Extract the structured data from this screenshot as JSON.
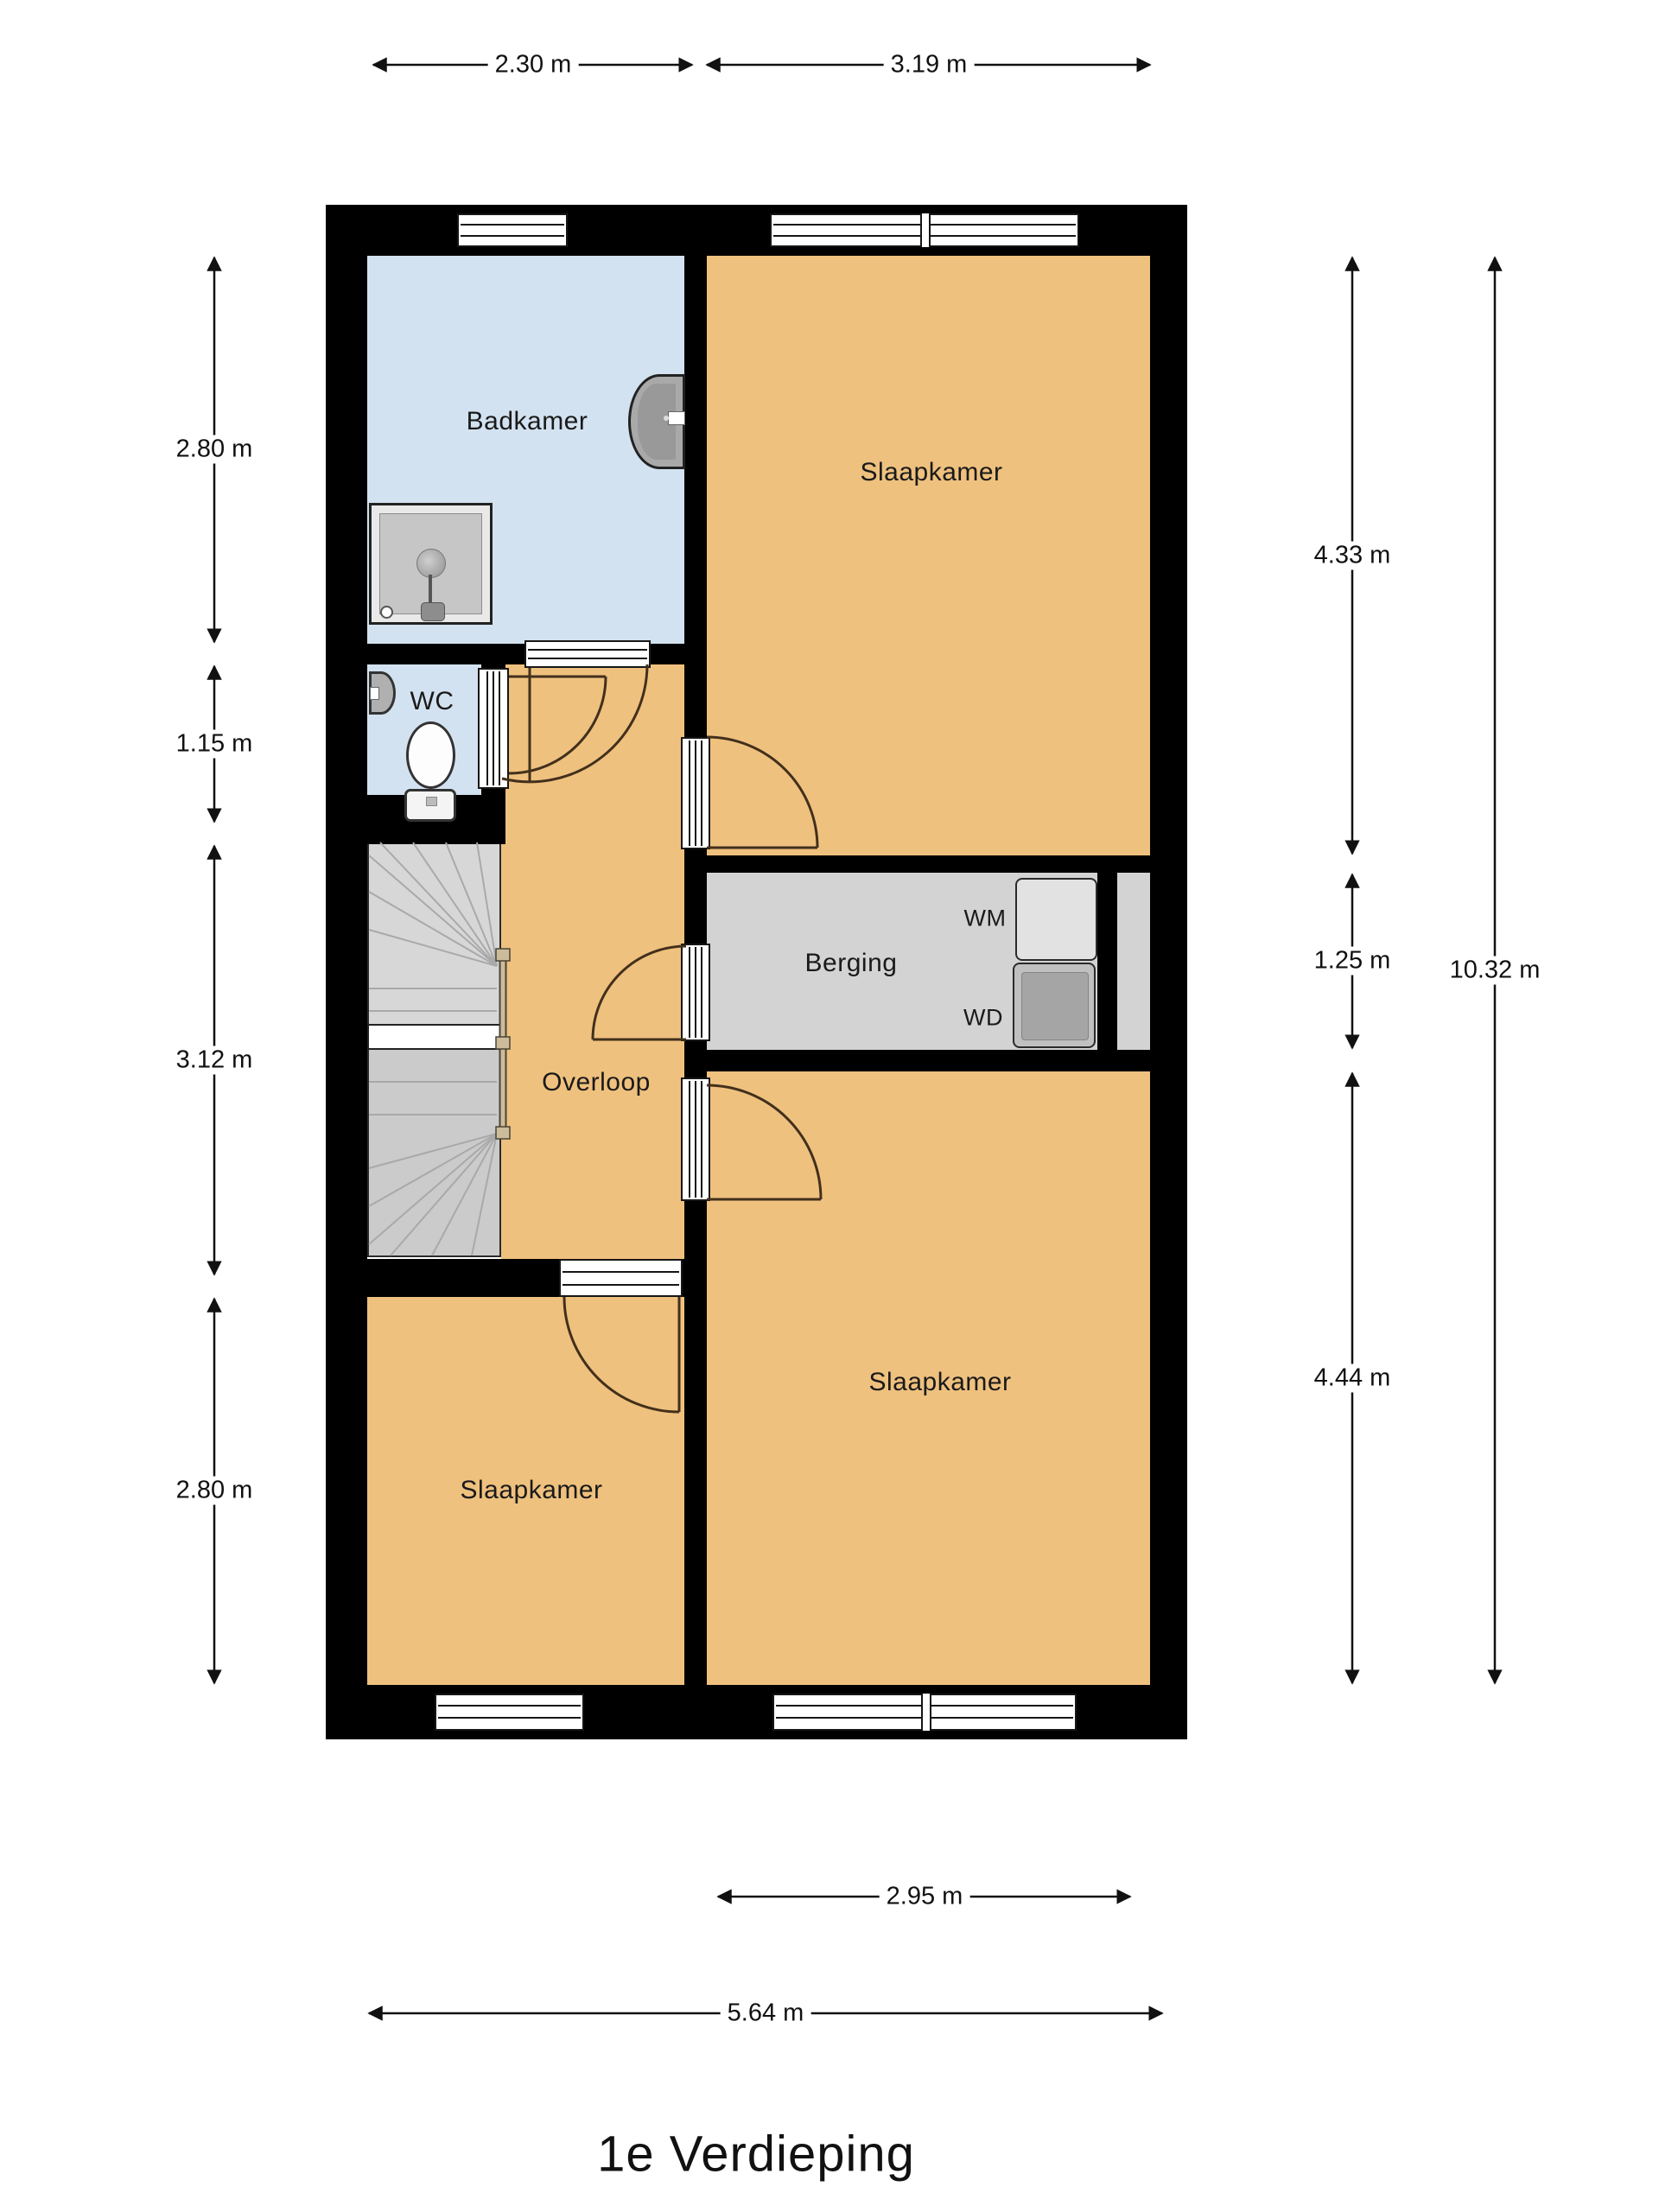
{
  "title": "1e Verdieping",
  "rooms": {
    "badkamer": "Badkamer",
    "wc": "WC",
    "overloop": "Overloop",
    "berging": "Berging",
    "slaapkamer_top": "Slaapkamer",
    "slaapkamer_left": "Slaapkamer",
    "slaapkamer_right": "Slaapkamer"
  },
  "appliances": {
    "washing_machine": "WM",
    "dryer": "WD"
  },
  "dimensions": {
    "top": [
      "2.30 m",
      "3.19 m"
    ],
    "left": [
      "2.80 m",
      "1.15 m",
      "3.12 m",
      "2.80 m"
    ],
    "right": [
      "4.33 m",
      "1.25 m",
      "4.44 m"
    ],
    "right_total": "10.32 m",
    "bottom": [
      "2.95 m",
      "5.64 m"
    ]
  },
  "colors": {
    "wall": "#000000",
    "room-orange": "#efc17e",
    "room-blue": "#d3e2f0",
    "room-gray": "#d3d3d3",
    "stairs-upper": "#d7d7d7",
    "stairs-lower": "#cbcbcb",
    "door-arc": "#42301c",
    "handrail": "#cdbc9b",
    "text": "#1a1a1a"
  }
}
